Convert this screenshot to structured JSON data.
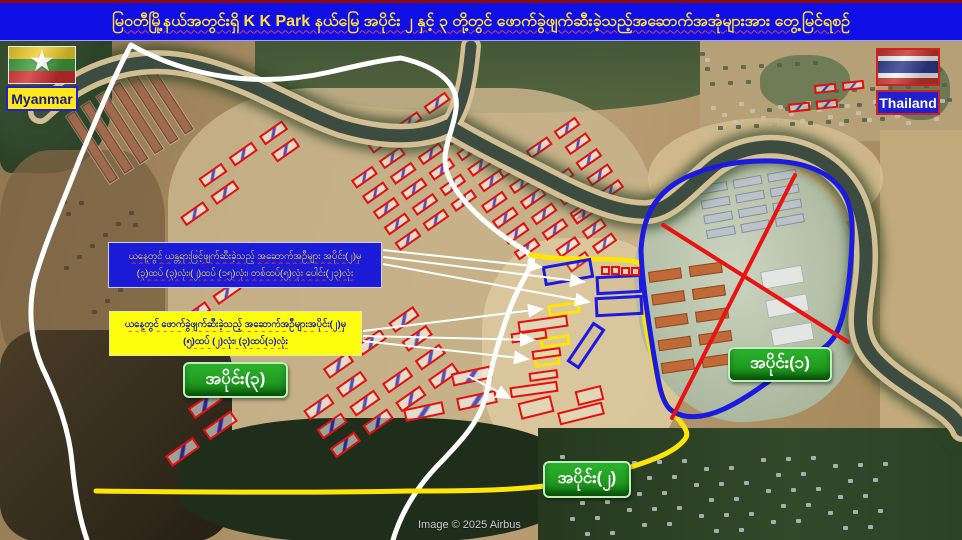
{
  "title": {
    "text": "မြဝတီမြို့နယ်အတွင်းရှိ K K Park နယ်မြေ အပိုင်း ၂ နှင့် ၃ တို့တွင် ဖောက်ခွဲဖျက်ဆီးခဲ့သည့်အဆောက်အအုံများအား တွေ့မြင်ရစဉ်"
  },
  "flags": {
    "myanmar": {
      "label": "Myanmar"
    },
    "thailand": {
      "label": "Thailand"
    }
  },
  "callouts": {
    "blue_box": {
      "line1": "ယနေ့တွင် ယန္တရားဖြင့်ဖျက်ဆီးခဲ့သည့် အဆောက်အဦများ အပိုင်း(၂)မှ",
      "line2": "(၃)ထပ် (၃)လုံး၊(၂)ထပ် (၁၅)လုံး၊ တစ်ထပ်(၅)လုံး ပေါင်း(၂၃)လုံး"
    },
    "yellow_box": {
      "line1": "ယနေ့တွင် ဖောက်ခွဲဖျက်ဆီးခဲ့သည့် အဆောက်အဦများအပိုင်း(၂)မှ",
      "line2": "(၅)ထပ် (၂)လုံး၊ (၃)ထပ်(၁)လုံး"
    }
  },
  "section_labels": {
    "s1": "အပိုင်း(၁)",
    "s2": "အပိုင်း(၂)",
    "s3": "အပိုင်း(၃)"
  },
  "attribution": "Image © 2025 Airbus",
  "colors": {
    "banner_bg": "#1010e6",
    "banner_text": "#ffdf3a",
    "blue_box_bg": "#1b1bd8",
    "blue_box_text": "#ffdf3a",
    "yellow_box_bg": "#fdfd0e",
    "yellow_box_text": "#1515b0",
    "label_bg": "#1f9a1f",
    "label_text": "#ffffff",
    "boundary_white": "#ffffff",
    "boundary_yellow": "#ffe40a",
    "boundary_blue": "#1a1ae0",
    "red_line": "#e81414",
    "building_red": "#e31010",
    "river_water": "#3c4c41",
    "river_sand": "#d9c498",
    "river_trees": "#2b4226"
  },
  "map": {
    "river": {
      "main": "M40,112 C85,70 140,52 200,68 C255,82 295,110 340,126 C380,138 420,140 448,126 C470,140 520,165 565,188 C600,205 625,213 648,212 C672,210 690,185 715,165 C735,150 765,142 795,150 C825,158 848,178 858,205 C866,228 868,255 864,285 C860,315 856,335 872,355 C890,377 920,392 945,410 C955,418 960,425 962,430",
      "branch": "M471,46 C469,68 466,100 452,122"
    },
    "boundaries": {
      "white_main": "M131,45 C190,78 260,88 330,72 C360,65 382,60 401,58 C443,68 459,87 456,109 C453,134 439,152 448,175 C458,200 488,227 518,246 C530,253 534,259 532,263 C524,280 514,295 507,317 C498,344 492,362 487,391 C481,421 461,441 442,461 C424,479 403,506 393,540",
      "white_left": "M131,45 C112,80 96,120 80,158 C62,205 44,245 34,282 C28,312 31,342 43,369 C58,400 69,430 72,462 C75,496 80,520 87,540",
      "yellow": "M531,255 C560,261 600,257 632,261 C641,262 643,268 642,280 C641,305 647,335 653,360 C657,383 664,404 678,419 C686,428 689,434 685,439 C676,451 656,459 634,466 C607,475 573,482 545,486 C505,491 452,491 410,491 C310,493 170,492 96,491",
      "blue": "M641,250 C643,215 656,196 676,183 C700,168 735,160 772,161 C805,162 830,172 843,192 C854,209 853,232 851,258 C849,288 845,316 836,334 C826,352 808,356 788,368 C768,381 748,398 724,409 C704,418 684,420 671,410 C661,402 658,380 653,350 C648,318 642,282 641,250 Z",
      "red_x": [
        [
          795,
          175,
          672,
          418
        ],
        [
          663,
          225,
          848,
          342
        ]
      ]
    },
    "arrows": [
      [
        383,
        250,
        541,
        267
      ],
      [
        383,
        257,
        584,
        282
      ],
      [
        383,
        264,
        589,
        302
      ],
      [
        363,
        331,
        542,
        309
      ],
      [
        363,
        336,
        534,
        340
      ],
      [
        363,
        341,
        528,
        359
      ],
      [
        468,
        376,
        510,
        398
      ]
    ],
    "clusters": [
      {
        "x": 150,
        "y": 62,
        "cols": 1,
        "rows": 6,
        "w": 80,
        "h": 10,
        "gx": 0,
        "gy": 8,
        "angle": 57,
        "type": "barracks"
      },
      {
        "x": 168,
        "y": 200,
        "cols": 4,
        "rows": 2,
        "w": 28,
        "h": 11,
        "gx": 9,
        "gy": 10,
        "angle": -35,
        "type": "red"
      },
      {
        "x": 170,
        "y": 300,
        "cols": 3,
        "rows": 2,
        "w": 28,
        "h": 11,
        "gx": 9,
        "gy": 10,
        "angle": -35,
        "type": "red"
      },
      {
        "x": 340,
        "y": 165,
        "cols": 4,
        "rows": 6,
        "w": 26,
        "h": 10,
        "gx": 8,
        "gy": 9,
        "angle": -35,
        "type": "red"
      },
      {
        "x": 470,
        "y": 190,
        "cols": 4,
        "rows": 5,
        "w": 26,
        "h": 10,
        "gx": 8,
        "gy": 9,
        "angle": -35,
        "type": "red"
      },
      {
        "x": 545,
        "y": 235,
        "cols": 2,
        "rows": 3,
        "w": 24,
        "h": 10,
        "gx": 8,
        "gy": 8,
        "angle": -35,
        "type": "red"
      },
      {
        "x": 290,
        "y": 392,
        "cols": 4,
        "rows": 4,
        "w": 30,
        "h": 12,
        "gx": 10,
        "gy": 11,
        "angle": -35,
        "type": "red"
      },
      {
        "x": 150,
        "y": 435,
        "cols": 3,
        "rows": 2,
        "w": 34,
        "h": 13,
        "gx": 12,
        "gy": 13,
        "angle": -35,
        "type": "red"
      },
      {
        "x": 398,
        "y": 385,
        "cols": 2,
        "rows": 2,
        "w": 40,
        "h": 13,
        "gx": 14,
        "gy": 12,
        "angle": -12,
        "type": "red"
      },
      {
        "x": 786,
        "y": 88,
        "cols": 3,
        "rows": 2,
        "w": 22,
        "h": 9,
        "gx": 6,
        "gy": 7,
        "angle": -6,
        "type": "red"
      },
      {
        "x": 698,
        "y": 186,
        "cols": 3,
        "rows": 4,
        "w": 29,
        "h": 9,
        "gx": 6,
        "gy": 6,
        "angle": -10,
        "type": "roof-gray"
      },
      {
        "x": 648,
        "y": 272,
        "cols": 2,
        "rows": 5,
        "w": 33,
        "h": 11,
        "gx": 8,
        "gy": 12,
        "angle": -8,
        "type": "roof-orange"
      },
      {
        "x": 760,
        "y": 272,
        "cols": 1,
        "rows": 3,
        "w": 42,
        "h": 18,
        "gx": 0,
        "gy": 11,
        "angle": -10,
        "type": "roof-white"
      }
    ],
    "annotated_rects": [
      [
        543,
        262,
        50,
        20,
        -10,
        "b"
      ],
      [
        596,
        275,
        46,
        19,
        -3,
        "b"
      ],
      [
        595,
        296,
        48,
        20,
        -3,
        "b"
      ],
      [
        562,
        338,
        48,
        15,
        -56,
        "b"
      ],
      [
        548,
        303,
        32,
        12,
        -8,
        "y"
      ],
      [
        540,
        336,
        30,
        11,
        -8,
        "y"
      ],
      [
        534,
        355,
        26,
        11,
        -8,
        "y"
      ],
      [
        601,
        266,
        9,
        9,
        0,
        "r"
      ],
      [
        611,
        266,
        9,
        9,
        0,
        "r"
      ],
      [
        621,
        267,
        9,
        9,
        0,
        "r"
      ],
      [
        631,
        267,
        9,
        9,
        0,
        "r"
      ],
      [
        518,
        318,
        50,
        12,
        -8,
        "r"
      ],
      [
        511,
        331,
        36,
        10,
        -8,
        "r"
      ],
      [
        532,
        349,
        29,
        9,
        -8,
        "r"
      ],
      [
        529,
        371,
        29,
        9,
        -8,
        "r"
      ],
      [
        510,
        384,
        48,
        11,
        -8,
        "r"
      ],
      [
        519,
        399,
        34,
        17,
        -14,
        "r"
      ],
      [
        558,
        407,
        46,
        13,
        -14,
        "r"
      ],
      [
        576,
        388,
        27,
        15,
        -14,
        "r"
      ]
    ],
    "dot_fields": [
      {
        "x": 700,
        "y": 52,
        "w": 250,
        "h": 75,
        "n": 42,
        "c": "#4f6247"
      },
      {
        "x": 705,
        "y": 58,
        "w": 240,
        "h": 66,
        "n": 26,
        "c": "#c9c2ae"
      },
      {
        "x": 560,
        "y": 455,
        "w": 330,
        "h": 78,
        "n": 60,
        "c": "#b9c2c6"
      },
      {
        "x": 62,
        "y": 200,
        "w": 80,
        "h": 120,
        "n": 14,
        "c": "#54452f"
      }
    ]
  }
}
